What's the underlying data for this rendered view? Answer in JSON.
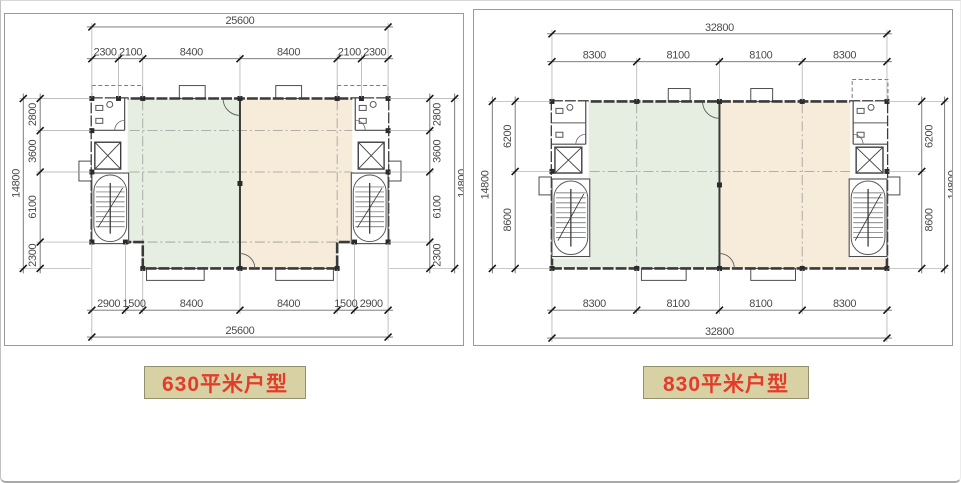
{
  "page": {
    "background": "#ffffff",
    "frame_color": "#c2c2c2"
  },
  "panels": [
    {
      "caption": {
        "text": "630平米户型",
        "bg": "#d8d1a3",
        "border": "#93906f",
        "color": "#e23c2b"
      },
      "plan": {
        "overall_width": "25600",
        "overall_height": "14800",
        "top_segments": [
          "2300",
          "2100",
          "8400",
          "8400",
          "2100",
          "2300"
        ],
        "bottom_segments": [
          "2900",
          "1500",
          "8400",
          "8400",
          "1500",
          "2900"
        ],
        "left_segments": [
          "2800",
          "3600",
          "6100",
          "2300"
        ],
        "right_segments": [
          "2800",
          "3600",
          "6100",
          "2300"
        ],
        "zone_colors": {
          "left": "#e6eee2",
          "right": "#f7ecda"
        },
        "wall_color": "#3a3a3a",
        "dim_color": "#4a4a4a"
      }
    },
    {
      "caption": {
        "text": "830平米户型",
        "bg": "#d8d1a3",
        "border": "#93906f",
        "color": "#e23c2b"
      },
      "plan": {
        "overall_width": "32800",
        "overall_height": "14800",
        "top_segments": [
          "8300",
          "8100",
          "8100",
          "8300"
        ],
        "bottom_segments": [
          "8300",
          "8100",
          "8100",
          "8300"
        ],
        "left_segments": [
          "6200",
          "8600"
        ],
        "right_segments": [
          "6200",
          "8600"
        ],
        "zone_colors": {
          "left": "#e6eee2",
          "right": "#f7ecda"
        },
        "wall_color": "#3a3a3a",
        "dim_color": "#4a4a4a"
      }
    }
  ]
}
